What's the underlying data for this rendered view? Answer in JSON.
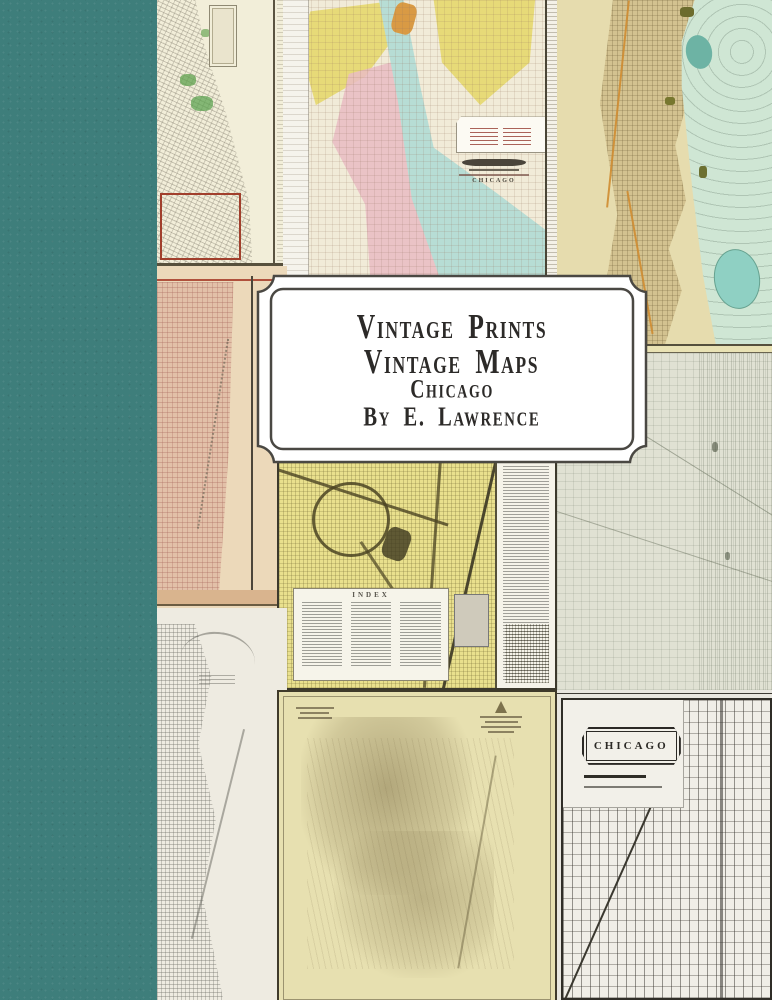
{
  "book_cover": {
    "title_plate": {
      "line1": "Vintage Prints",
      "line2": "Vintage Maps",
      "line3": "Chicago",
      "line4": "By E. Lawrence",
      "background": "#ffffff",
      "border_color": "#4a4843",
      "text_color": "#2c2a28"
    },
    "spine": {
      "color": "#3e7e7b"
    },
    "map_labels": {
      "bottom_right_map_title": "CHICAGO",
      "center_map_index_heading": "INDEX",
      "top_center_cartouche": "CHICAGO"
    },
    "palette": {
      "cream_paper": "#f2eed9",
      "pastel_yellow": "#e6d86e",
      "pastel_pink": "#e9bcc3",
      "river_blue": "#b7ddd5",
      "lake_green": "#cfe6d4",
      "olive_tan": "#d3c290",
      "salmon": "#e2c0a8",
      "sage_grey": "#e0e1d3",
      "detail_yellow": "#e9e08d",
      "khaki": "#e7e0b0",
      "street_grey": "#f0eee7",
      "plat_red_outline": "#a13f2c"
    }
  }
}
